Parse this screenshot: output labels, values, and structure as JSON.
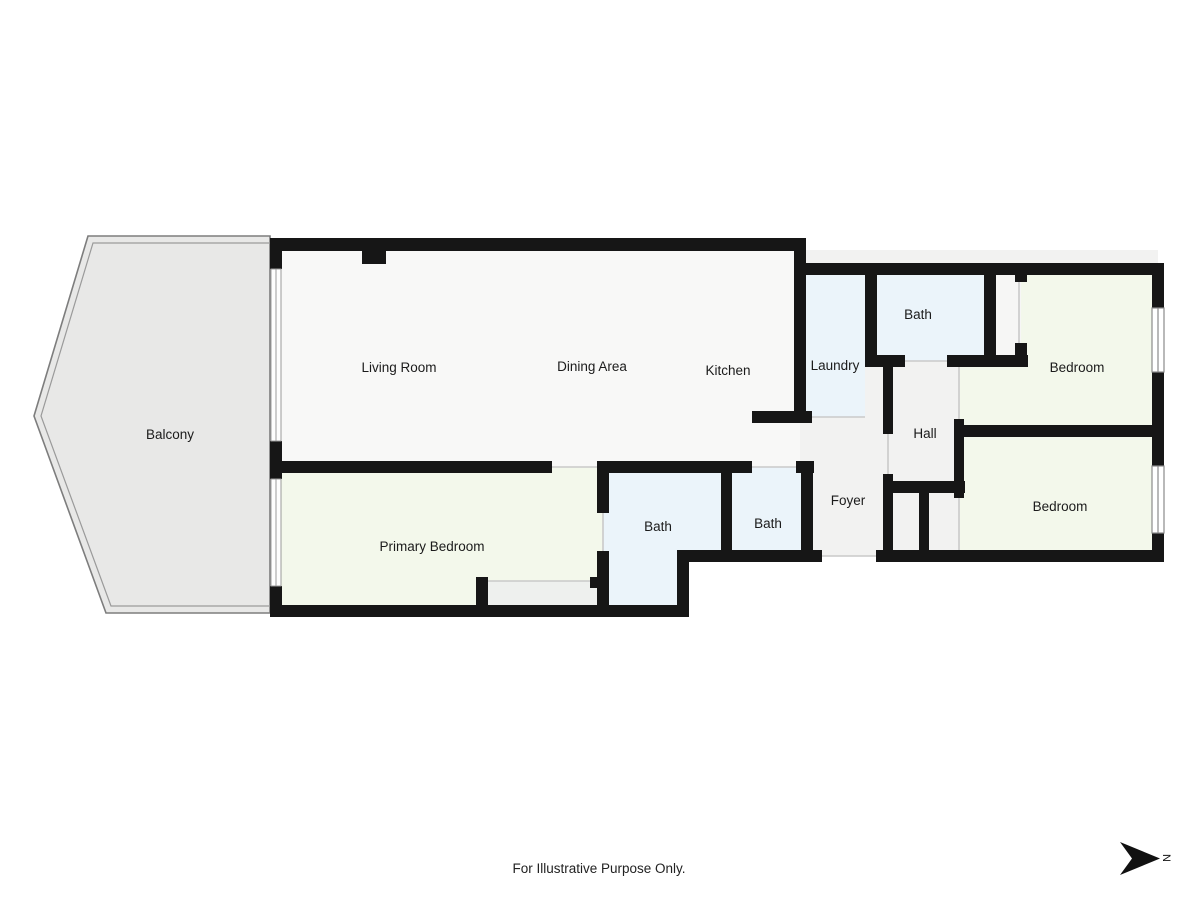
{
  "title": "Floor Plan",
  "rooms": {
    "balcony": {
      "label": "Balcony"
    },
    "living_room": {
      "label": "Living Room"
    },
    "dining_area": {
      "label": "Dining Area"
    },
    "kitchen": {
      "label": "Kitchen"
    },
    "laundry": {
      "label": "Laundry"
    },
    "bath_upper": {
      "label": "Bath"
    },
    "bedroom_top": {
      "label": "Bedroom"
    },
    "hall": {
      "label": "Hall"
    },
    "foyer": {
      "label": "Foyer"
    },
    "bedroom_bottom": {
      "label": "Bedroom"
    },
    "primary_bedroom": {
      "label": "Primary Bedroom"
    },
    "bath_ensuite": {
      "label": "Bath"
    },
    "bath_second": {
      "label": "Bath"
    }
  },
  "footer": {
    "disclaimer": "For Illustrative Purpose Only."
  },
  "compass": {
    "label": "N"
  },
  "colors": {
    "wall": "#161616",
    "floor_base": "#f2f2f1",
    "living": "#f8f8f7",
    "bedroom": "#f3f8eb",
    "bath": "#ebf4fa",
    "balcony": "#e8e8e7",
    "closet": "#f6f6f5",
    "closet_inner": "#eef0ee",
    "door_line": "#c9c9c9",
    "window_line": "#8a8a8a"
  }
}
